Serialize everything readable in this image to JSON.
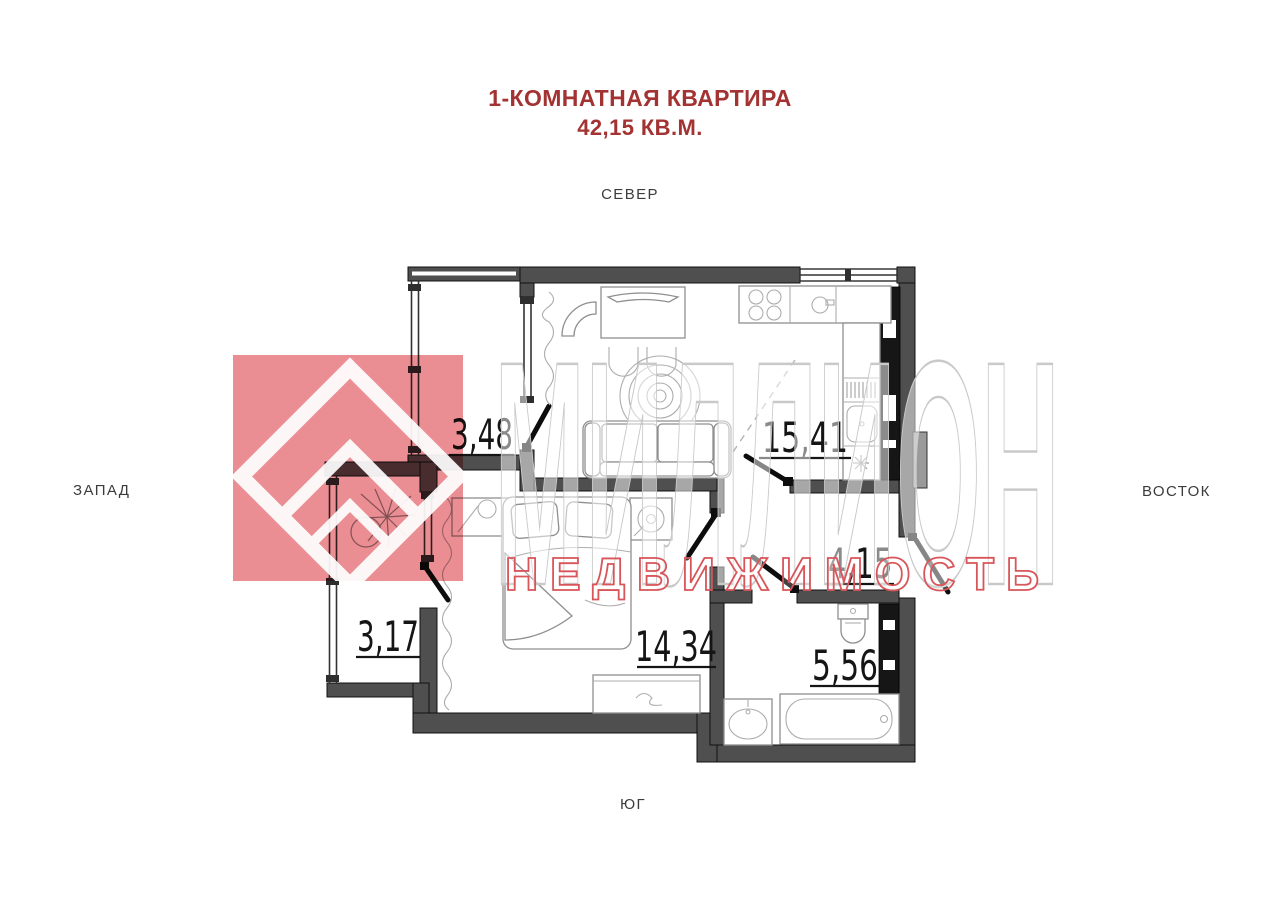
{
  "title": {
    "line1": "1-КОМНАТНАЯ КВАРТИРА",
    "line2": "42,15 КВ.М."
  },
  "compass": {
    "north": "СЕВЕР",
    "south": "ЮГ",
    "west": "ЗАПАД",
    "east": "ВОСТОК"
  },
  "rooms": {
    "balcony_top": {
      "area": "3,48"
    },
    "kitchen_living": {
      "area": "15,41"
    },
    "balcony_bottom": {
      "area": "3,17"
    },
    "bedroom": {
      "area": "14,34"
    },
    "hall": {
      "area": "4,15"
    },
    "bathroom": {
      "area": "5,56"
    }
  },
  "watermark": {
    "line1": "МИЛЛИОН",
    "line2": "НЕДВИЖИМОСТЬ"
  },
  "colors": {
    "title_red": "#a33232",
    "wall_gray": "#4f4f4f",
    "logo_red": "#e0535a",
    "watermark_gray": "#c9c9c9",
    "watermark_text_red": "#d8565a",
    "compass_text": "#3c3c3c"
  }
}
